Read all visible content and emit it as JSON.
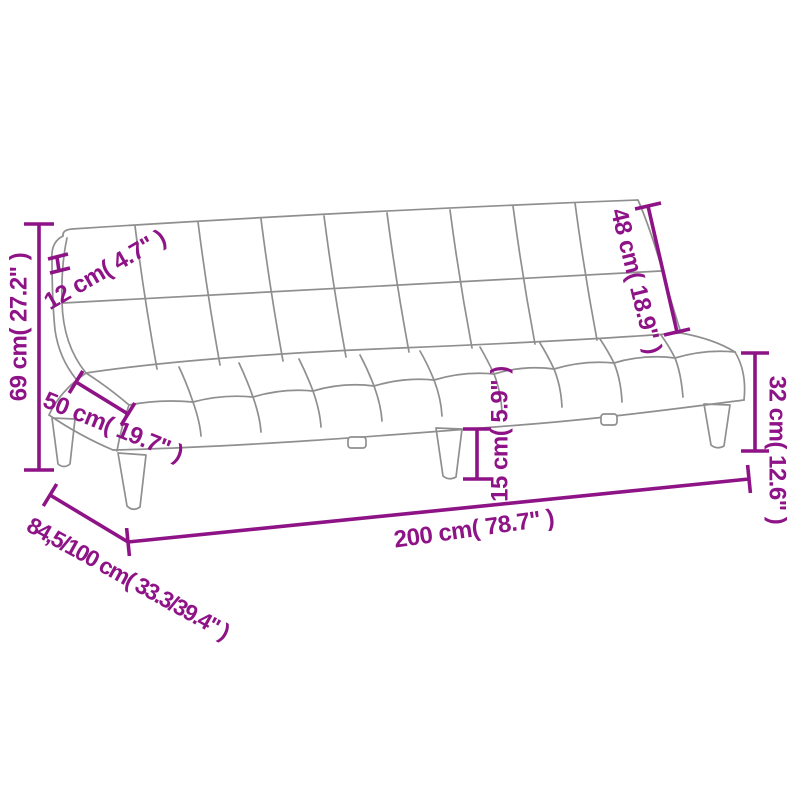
{
  "colors": {
    "dimension-line": "#8E1387",
    "sofa-outline": "#8F8F8F",
    "background": "#FFFFFF"
  },
  "labels": {
    "overall_height": "69 cm( 27.2\" )",
    "backrest_thickness": "12 cm( 4.7\" )",
    "seat_depth": "50 cm( 19.7\" )",
    "backrest_height": "48 cm( 18.9\" )",
    "seat_height": "32 cm( 12.6\" )",
    "leg_height": "15 cm( 5.9\" )",
    "overall_width": "200 cm( 78.7\" )",
    "overall_depth": "84,5/100 cm( 33.3/39.4\" )"
  }
}
